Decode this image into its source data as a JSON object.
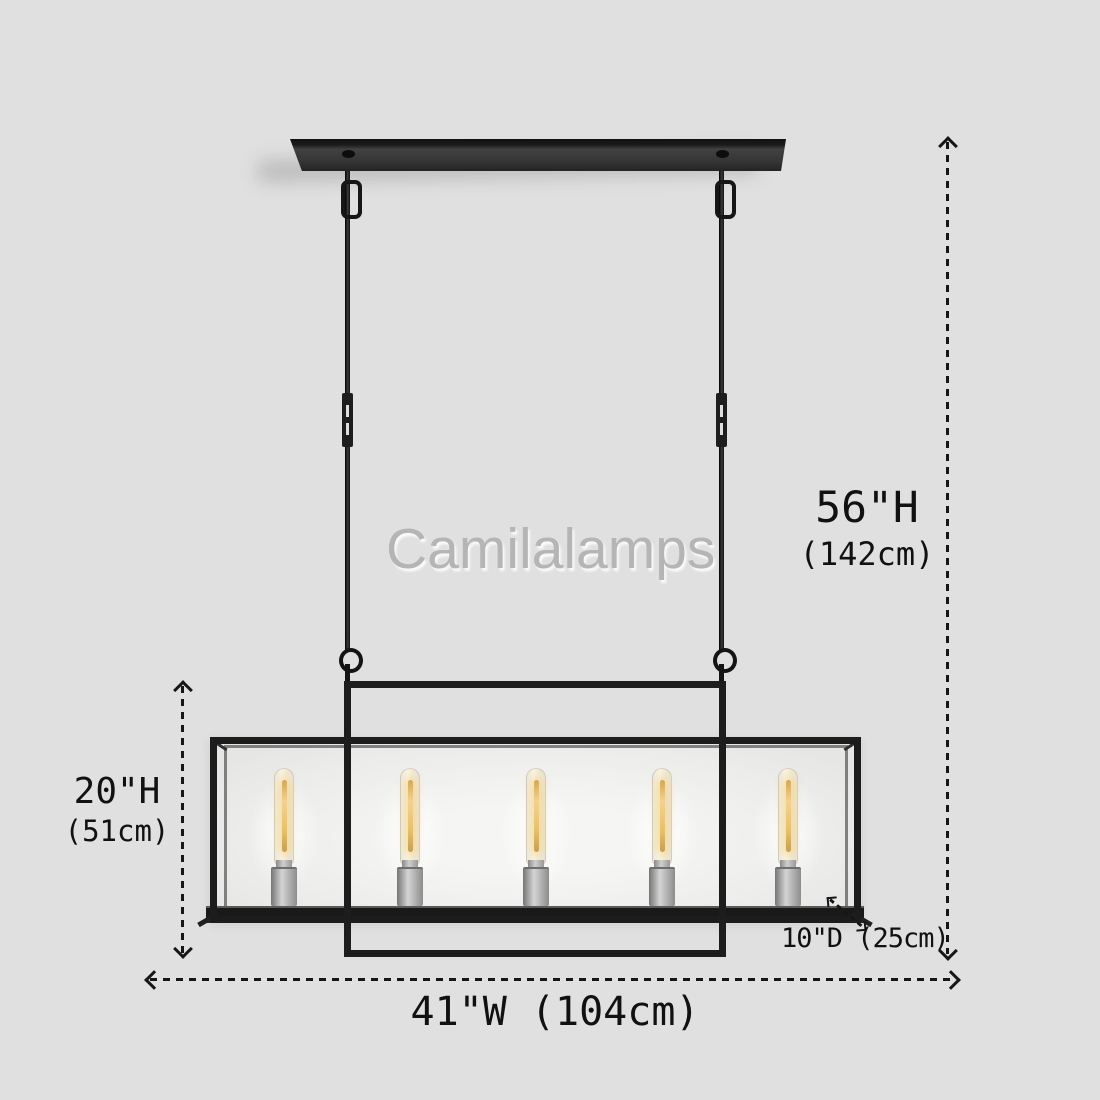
{
  "watermark": {
    "text": "Camilalamps",
    "color": "#b5b5b5"
  },
  "fixture": {
    "description": "linear rectangular glass-box chandelier with ceiling plate and two suspension rods",
    "bulb_count": 5,
    "colors": {
      "background": "#e0e0e0",
      "frame_black": "#1d1d1d",
      "socket_silver": "#c0c0c0",
      "filament_warm": "#ecbf63",
      "dimension_ink": "#161616"
    }
  },
  "dimensions": {
    "overall_height": {
      "imperial": "56\"H",
      "metric": "(142cm)"
    },
    "shade_height": {
      "imperial": "20\"H",
      "metric": "(51cm)"
    },
    "width": {
      "label": "41\"W (104cm)"
    },
    "depth": {
      "label": "10\"D (25cm)"
    }
  }
}
